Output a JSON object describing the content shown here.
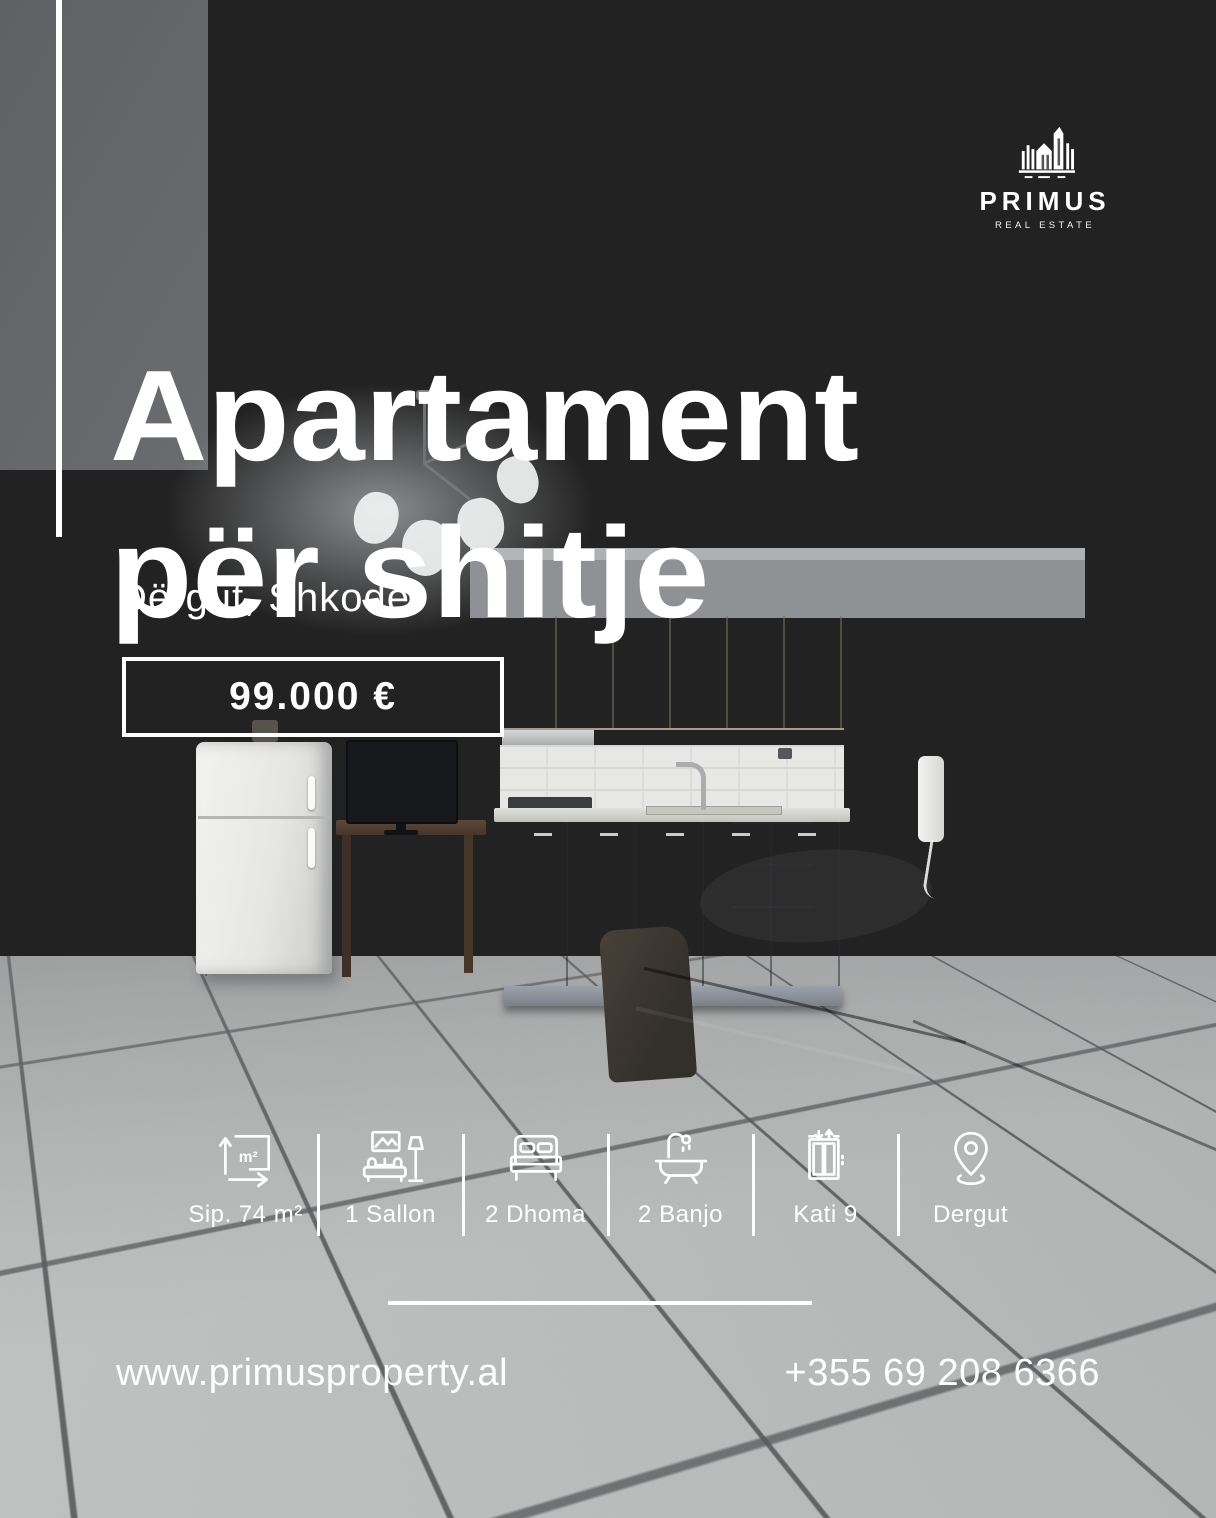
{
  "brand": {
    "name": "PRIMUS",
    "tagline": "REAL ESTATE"
  },
  "headline": {
    "line1": "Apartament",
    "line2": "për shitje"
  },
  "location": "Dërgut, Shkodër",
  "price": "99.000 €",
  "features": [
    {
      "icon": "area-icon",
      "icon_text": "m²",
      "label": "Sip. 74 m²"
    },
    {
      "icon": "sofa-lamp-icon",
      "label": "1 Sallon"
    },
    {
      "icon": "bed-icon",
      "label": "2 Dhoma"
    },
    {
      "icon": "bathtub-icon",
      "label": "2 Banjo"
    },
    {
      "icon": "elevator-icon",
      "label": "Kati 9"
    },
    {
      "icon": "location-pin-icon",
      "label": "Dergut"
    }
  ],
  "contact": {
    "website": "www.primusproperty.al",
    "phone": "+355 69 208 6366"
  },
  "colors": {
    "text": "#ffffff",
    "accent_line": "#ffffff",
    "price_border": "#ffffff"
  }
}
